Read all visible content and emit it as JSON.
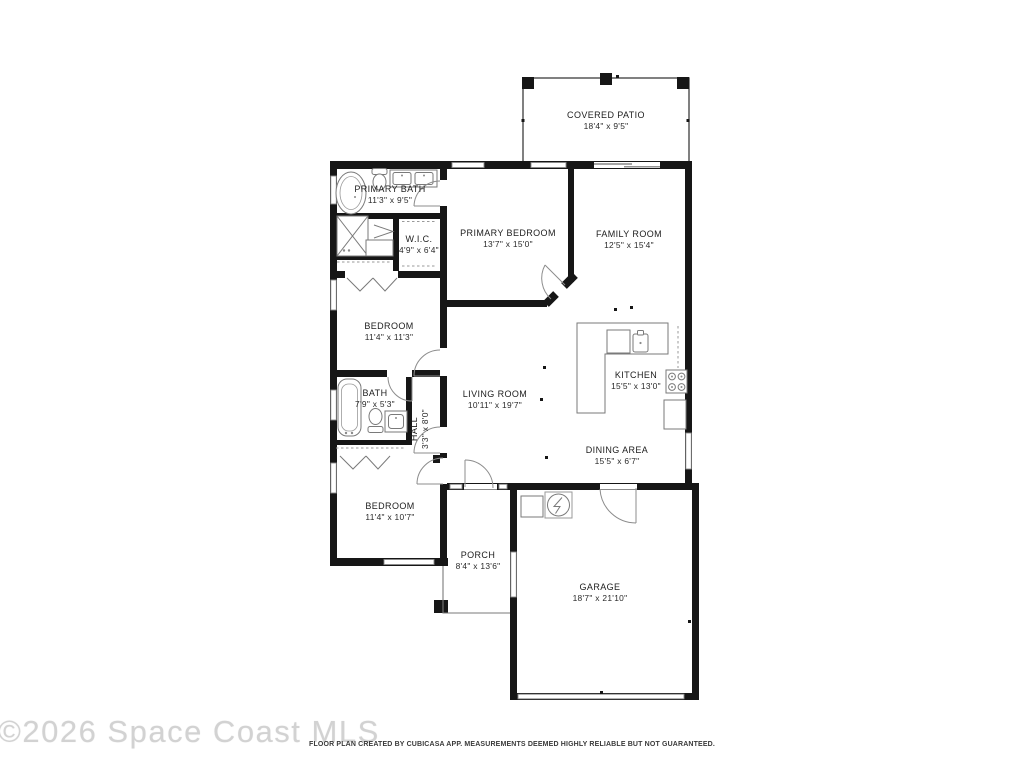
{
  "floorplan": {
    "rooms": [
      {
        "name": "COVERED PATIO",
        "dims": "18'4\" x 9'5\""
      },
      {
        "name": "PRIMARY BATH",
        "dims": "11'3\" x 9'5\""
      },
      {
        "name": "W.I.C.",
        "dims": "4'9\" x 6'4\""
      },
      {
        "name": "PRIMARY BEDROOM",
        "dims": "13'7\" x 15'0\""
      },
      {
        "name": "FAMILY ROOM",
        "dims": "12'5\" x 15'4\""
      },
      {
        "name": "BEDROOM",
        "dims": "11'4\" x 11'3\""
      },
      {
        "name": "BATH",
        "dims": "7'9\" x 5'3\""
      },
      {
        "name": "HALL",
        "dims": "3'3\" x 8'0\""
      },
      {
        "name": "LIVING ROOM",
        "dims": "10'11\" x 19'7\""
      },
      {
        "name": "KITCHEN",
        "dims": "15'5\" x 13'0\""
      },
      {
        "name": "DINING AREA",
        "dims": "15'5\" x 6'7\""
      },
      {
        "name": "BEDROOM",
        "dims": "11'4\" x 10'7\""
      },
      {
        "name": "PORCH",
        "dims": "8'4\" x 13'6\""
      },
      {
        "name": "GARAGE",
        "dims": "18'7\" x 21'10\""
      }
    ],
    "watermark": "©2026 Space Coast MLS",
    "footer": "FLOOR PLAN CREATED BY CUBICASA APP. MEASUREMENTS DEEMED HIGHLY RELIABLE BUT NOT GUARANTEED.",
    "colors": {
      "wall": "#161616",
      "fixture": "#7a7a7a",
      "watermark": "#d2d2d2"
    }
  }
}
